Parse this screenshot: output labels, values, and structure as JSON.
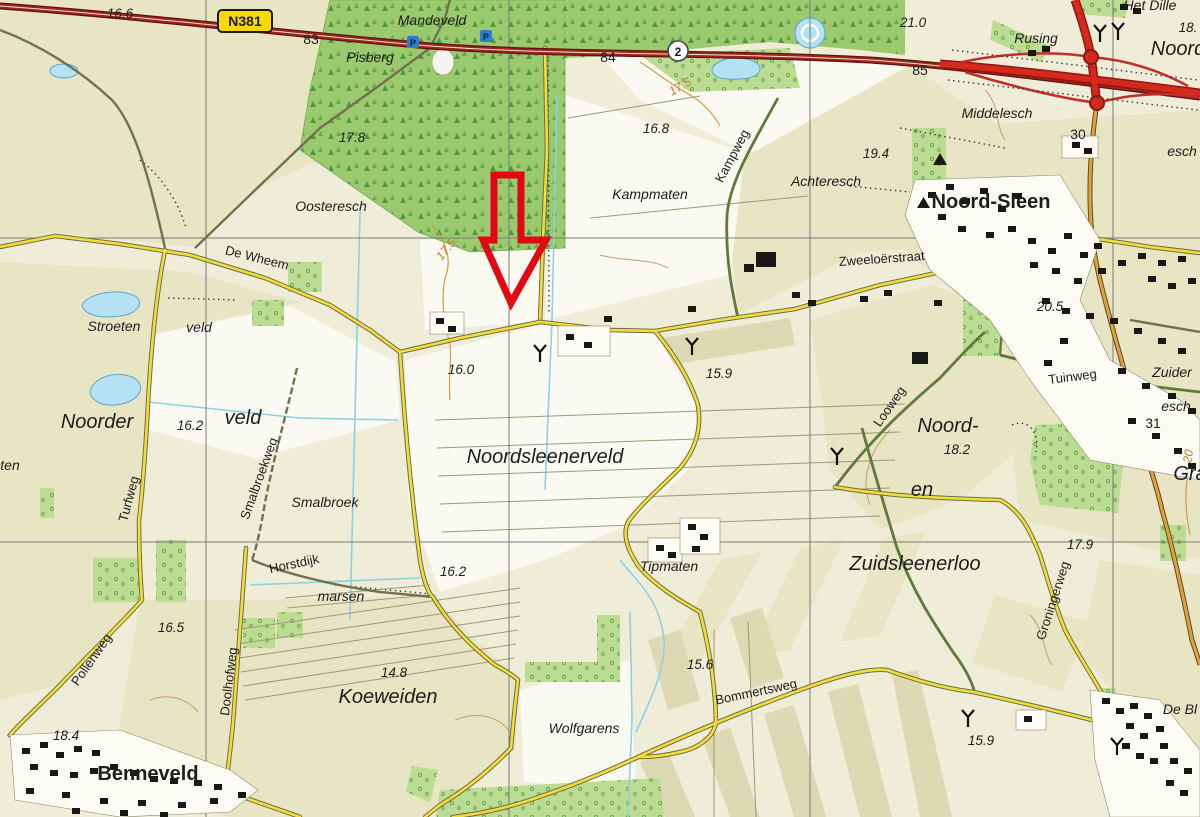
{
  "shields": {
    "n381_label": "N381",
    "route_2_label": "2",
    "parking_label": "P"
  },
  "colors": {
    "arrow_red": "#e30613",
    "road_yellow": "#f3de39",
    "road_main_red": "#9e241b",
    "highway_red": "#d42a1e",
    "road_tan": "#dfa23e",
    "forest_green": "#9aca6d",
    "water_blue": "#b5e1f5",
    "field_khaki": "#e8e5c5",
    "field_white": "#fbfaf2",
    "background": "#efecd8",
    "grid_gray": "#7a7a7a",
    "contour_orange": "#c07f28"
  },
  "map_labels": [
    {
      "text": "16.6",
      "x": 120,
      "y": 18,
      "rot": 0,
      "cls": "lbl-spot"
    },
    {
      "text": "83",
      "x": 311,
      "y": 44,
      "rot": 0,
      "cls": "lbl-grid"
    },
    {
      "text": "Mandeveld",
      "x": 432,
      "y": 25,
      "rot": 0,
      "cls": "lbl-area"
    },
    {
      "text": "84",
      "x": 608,
      "y": 62,
      "rot": 0,
      "cls": "lbl-grid"
    },
    {
      "text": "85",
      "x": 920,
      "y": 75,
      "rot": 0,
      "cls": "lbl-grid"
    },
    {
      "text": "17.5",
      "x": 682,
      "y": 90,
      "rot": -30,
      "cls": "lbl-contour"
    },
    {
      "text": "21.0",
      "x": 913,
      "y": 27,
      "rot": 0,
      "cls": "lbl-spot"
    },
    {
      "text": "Rusing",
      "x": 1036,
      "y": 43,
      "rot": 0,
      "cls": "lbl-area"
    },
    {
      "text": "Het Dille",
      "x": 1150,
      "y": 10,
      "rot": 0,
      "cls": "lbl-area"
    },
    {
      "text": "18.",
      "x": 1188,
      "y": 32,
      "rot": 0,
      "cls": "lbl-spot"
    },
    {
      "text": "Noord",
      "x": 1178,
      "y": 55,
      "rot": 0,
      "cls": "lbl-area-lg"
    },
    {
      "text": "Pisberg",
      "x": 370,
      "y": 62,
      "rot": 0,
      "cls": "lbl-area"
    },
    {
      "text": "Middelesch",
      "x": 997,
      "y": 118,
      "rot": 0,
      "cls": "lbl-area"
    },
    {
      "text": "esch",
      "x": 1182,
      "y": 156,
      "rot": 0,
      "cls": "lbl-area"
    },
    {
      "text": "30",
      "x": 1078,
      "y": 139,
      "rot": 0,
      "cls": "lbl-grid"
    },
    {
      "text": "17.8",
      "x": 352,
      "y": 142,
      "rot": 0,
      "cls": "lbl-spot"
    },
    {
      "text": "16.8",
      "x": 656,
      "y": 133,
      "rot": 0,
      "cls": "lbl-spot"
    },
    {
      "text": "Kampweg",
      "x": 736,
      "y": 158,
      "rot": -62,
      "cls": "lbl-road"
    },
    {
      "text": "Achteresch",
      "x": 826,
      "y": 186,
      "rot": 0,
      "cls": "lbl-area"
    },
    {
      "text": "19.4",
      "x": 876,
      "y": 158,
      "rot": 0,
      "cls": "lbl-spot"
    },
    {
      "text": "Noord-Sleen",
      "x": 991,
      "y": 208,
      "rot": 0,
      "cls": "lbl-town"
    },
    {
      "text": "Oosteresch",
      "x": 331,
      "y": 211,
      "rot": 0,
      "cls": "lbl-area"
    },
    {
      "text": "Kampmaten",
      "x": 650,
      "y": 199,
      "rot": 0,
      "cls": "lbl-area"
    },
    {
      "text": "De Wheem",
      "x": 256,
      "y": 262,
      "rot": 14,
      "cls": "lbl-road"
    },
    {
      "text": "17.5",
      "x": 449,
      "y": 252,
      "rot": -50,
      "cls": "lbl-contour"
    },
    {
      "text": "Zweeloërstraat",
      "x": 882,
      "y": 263,
      "rot": -4,
      "cls": "lbl-road"
    },
    {
      "text": "Stroeten",
      "x": 114,
      "y": 331,
      "rot": 0,
      "cls": "lbl-area"
    },
    {
      "text": "veld",
      "x": 199,
      "y": 332,
      "rot": 0,
      "cls": "lbl-area"
    },
    {
      "text": "ten",
      "x": 10,
      "y": 470,
      "rot": 0,
      "cls": "lbl-area"
    },
    {
      "text": "Noorder",
      "x": 97,
      "y": 428,
      "rot": 0,
      "cls": "lbl-area-lg"
    },
    {
      "text": "16.2",
      "x": 190,
      "y": 430,
      "rot": 0,
      "cls": "lbl-spot"
    },
    {
      "text": "veld",
      "x": 243,
      "y": 424,
      "rot": 0,
      "cls": "lbl-area-lg"
    },
    {
      "text": "Turfweg",
      "x": 133,
      "y": 500,
      "rot": -75,
      "cls": "lbl-road"
    },
    {
      "text": "Smalbroekweg",
      "x": 263,
      "y": 480,
      "rot": -70,
      "cls": "lbl-road"
    },
    {
      "text": "Smalbroek",
      "x": 325,
      "y": 507,
      "rot": 0,
      "cls": "lbl-area"
    },
    {
      "text": "Horstdijk",
      "x": 295,
      "y": 568,
      "rot": -12,
      "cls": "lbl-road"
    },
    {
      "text": "16.0",
      "x": 461,
      "y": 374,
      "rot": 0,
      "cls": "lbl-spot"
    },
    {
      "text": "15.9",
      "x": 719,
      "y": 378,
      "rot": 0,
      "cls": "lbl-spot"
    },
    {
      "text": "Noordsleenerveld",
      "x": 545,
      "y": 463,
      "rot": 0,
      "cls": "lbl-area-lg"
    },
    {
      "text": "Looweg",
      "x": 893,
      "y": 409,
      "rot": -55,
      "cls": "lbl-road"
    },
    {
      "text": "Noord-",
      "x": 948,
      "y": 432,
      "rot": 0,
      "cls": "lbl-area-lg"
    },
    {
      "text": "18.2",
      "x": 957,
      "y": 454,
      "rot": 0,
      "cls": "lbl-spot"
    },
    {
      "text": "en",
      "x": 922,
      "y": 496,
      "rot": 0,
      "cls": "lbl-area-lg"
    },
    {
      "text": "20.5",
      "x": 1050,
      "y": 311,
      "rot": 0,
      "cls": "lbl-spot"
    },
    {
      "text": "Tuinweg",
      "x": 1073,
      "y": 381,
      "rot": -7,
      "cls": "lbl-road"
    },
    {
      "text": "Zuider",
      "x": 1172,
      "y": 377,
      "rot": 0,
      "cls": "lbl-area"
    },
    {
      "text": "esch",
      "x": 1176,
      "y": 411,
      "rot": 0,
      "cls": "lbl-area"
    },
    {
      "text": "31",
      "x": 1153,
      "y": 428,
      "rot": 0,
      "cls": "lbl-grid"
    },
    {
      "text": "Gra",
      "x": 1190,
      "y": 480,
      "rot": 0,
      "cls": "lbl-area-lg"
    },
    {
      "text": "20",
      "x": 1192,
      "y": 457,
      "rot": -80,
      "cls": "lbl-contour"
    },
    {
      "text": "17.9",
      "x": 1080,
      "y": 549,
      "rot": 0,
      "cls": "lbl-spot"
    },
    {
      "text": "Groningerweg",
      "x": 1057,
      "y": 602,
      "rot": -72,
      "cls": "lbl-road"
    },
    {
      "text": "Zuidsleenerloo",
      "x": 915,
      "y": 570,
      "rot": 0,
      "cls": "lbl-area-lg"
    },
    {
      "text": "Tipmaten",
      "x": 669,
      "y": 571,
      "rot": 0,
      "cls": "lbl-area"
    },
    {
      "text": "marsen",
      "x": 341,
      "y": 601,
      "rot": 0,
      "cls": "lbl-area"
    },
    {
      "text": "16.2",
      "x": 453,
      "y": 576,
      "rot": 0,
      "cls": "lbl-spot"
    },
    {
      "text": "16.5",
      "x": 171,
      "y": 632,
      "rot": 0,
      "cls": "lbl-spot"
    },
    {
      "text": "Pollenweg",
      "x": 95,
      "y": 662,
      "rot": -55,
      "cls": "lbl-road"
    },
    {
      "text": "Doolhofweg",
      "x": 233,
      "y": 682,
      "rot": -83,
      "cls": "lbl-road"
    },
    {
      "text": "18.4",
      "x": 66,
      "y": 740,
      "rot": 0,
      "cls": "lbl-spot"
    },
    {
      "text": "Benneveld",
      "x": 148,
      "y": 780,
      "rot": 0,
      "cls": "lbl-town"
    },
    {
      "text": "14.8",
      "x": 394,
      "y": 677,
      "rot": 0,
      "cls": "lbl-spot"
    },
    {
      "text": "Koeweiden",
      "x": 388,
      "y": 703,
      "rot": 0,
      "cls": "lbl-area-lg"
    },
    {
      "text": "Wolfgarens",
      "x": 584,
      "y": 733,
      "rot": 0,
      "cls": "lbl-area"
    },
    {
      "text": "15.6",
      "x": 700,
      "y": 669,
      "rot": 0,
      "cls": "lbl-spot"
    },
    {
      "text": "Bommertsweg",
      "x": 757,
      "y": 696,
      "rot": -12,
      "cls": "lbl-road"
    },
    {
      "text": "15.9",
      "x": 981,
      "y": 745,
      "rot": 0,
      "cls": "lbl-spot"
    },
    {
      "text": "De Bl",
      "x": 1180,
      "y": 714,
      "rot": 0,
      "cls": "lbl-area"
    }
  ]
}
